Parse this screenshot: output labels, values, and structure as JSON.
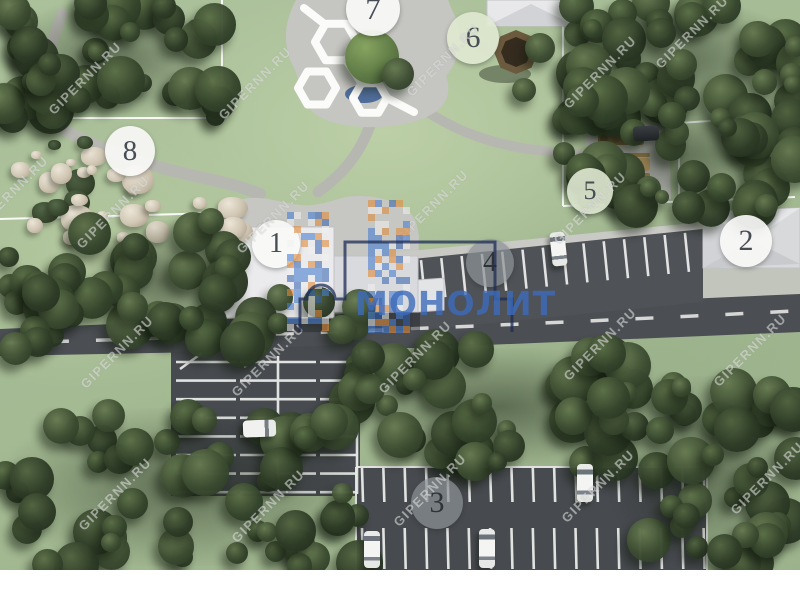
{
  "watermark": {
    "text": "GIPERNN.RU",
    "instances": [
      [
        85,
        78
      ],
      [
        255,
        83
      ],
      [
        443,
        60
      ],
      [
        600,
        72
      ],
      [
        692,
        32
      ],
      [
        113,
        212
      ],
      [
        273,
        217
      ],
      [
        432,
        206
      ],
      [
        590,
        208
      ],
      [
        12,
        192
      ],
      [
        117,
        352
      ],
      [
        268,
        360
      ],
      [
        415,
        357
      ],
      [
        600,
        344
      ],
      [
        750,
        350
      ],
      [
        115,
        494
      ],
      [
        268,
        506
      ],
      [
        430,
        490
      ],
      [
        598,
        486
      ],
      [
        767,
        478
      ]
    ]
  },
  "logo": {
    "text": "МОНОЛИТ"
  },
  "markers": [
    {
      "label": "1",
      "x": 276,
      "y": 244,
      "r": 24,
      "variant": "light"
    },
    {
      "label": "2",
      "x": 746,
      "y": 241,
      "r": 26,
      "variant": "light"
    },
    {
      "label": "3",
      "x": 437,
      "y": 503,
      "r": 26,
      "variant": "dark"
    },
    {
      "label": "4",
      "x": 490,
      "y": 263,
      "r": 24,
      "variant": "dark"
    },
    {
      "label": "5",
      "x": 590,
      "y": 191,
      "r": 23,
      "variant": "green"
    },
    {
      "label": "6",
      "x": 473,
      "y": 38,
      "r": 26,
      "variant": "green"
    },
    {
      "label": "7",
      "x": 373,
      "y": 9,
      "r": 27,
      "variant": "light"
    },
    {
      "label": "8",
      "x": 130,
      "y": 151,
      "r": 25,
      "variant": "light"
    }
  ],
  "cars": [
    {
      "x": 551,
      "y": 232,
      "w": 15,
      "h": 34,
      "rot": -6,
      "tone": "light"
    },
    {
      "x": 243,
      "y": 420,
      "w": 33,
      "h": 17,
      "rot": -2,
      "tone": "light",
      "kind": "van"
    },
    {
      "x": 364,
      "y": 531,
      "w": 16,
      "h": 37,
      "rot": 0,
      "tone": "light"
    },
    {
      "x": 479,
      "y": 529,
      "w": 16,
      "h": 39,
      "rot": 0,
      "tone": "light"
    },
    {
      "x": 577,
      "y": 464,
      "w": 16,
      "h": 38,
      "rot": 0,
      "tone": "light"
    },
    {
      "x": 633,
      "y": 126,
      "w": 26,
      "h": 15,
      "rot": -3,
      "tone": "dark"
    }
  ],
  "colors": {
    "grass": "#a8bd97",
    "asphalt": "#4b4e53",
    "path": "#b7b7b1",
    "plaza": "#c6c6c2",
    "roof_light": "#ebebed",
    "roof_gray": "#d8d9db",
    "logo_blue": "#3c6cbc",
    "mosaic_orange": "#e08a3c",
    "mosaic_blue": "#4a7fd0",
    "boundary_line": "#ffffff"
  }
}
